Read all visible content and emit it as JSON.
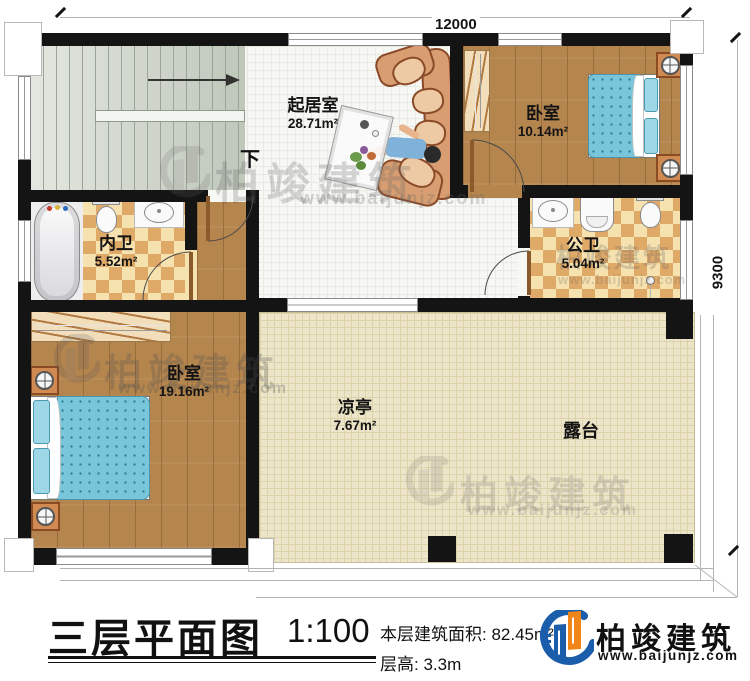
{
  "plan": {
    "dimension_top": "12000",
    "dimension_right": "9300",
    "stair_direction_label": "下",
    "rooms": [
      {
        "name": "起居室",
        "area": "28.71m²"
      },
      {
        "name": "卧室",
        "area": "10.14m²"
      },
      {
        "name": "内卫",
        "area": "5.52m²"
      },
      {
        "name": "公卫",
        "area": "5.04m²"
      },
      {
        "name": "卧室",
        "area": "19.16m²"
      },
      {
        "name": "凉亭",
        "area": "7.67m²"
      },
      {
        "name": "露台",
        "area": ""
      }
    ]
  },
  "caption": {
    "title": "三层平面图",
    "scale": "1:100",
    "floor_area_label": "本层建筑面积:",
    "floor_area_value": "82.45m²",
    "floor_height_label": "层高:",
    "floor_height_value": "3.3m"
  },
  "brand": {
    "name": "柏竣建筑",
    "website": "www.baijunjz.com"
  },
  "watermark": {
    "name": "柏竣建筑",
    "website": "www.baijunjz.com"
  },
  "colors": {
    "brand_blue": "#1a5dab",
    "brand_orange": "#f08519",
    "wall": "#141414",
    "wood_floor": "#b5854e",
    "checker_tile": "#dfa967",
    "bed_blue": "#79c6da",
    "terrace_floor": "#ece5c9",
    "stairs": "#cbd3c6"
  }
}
